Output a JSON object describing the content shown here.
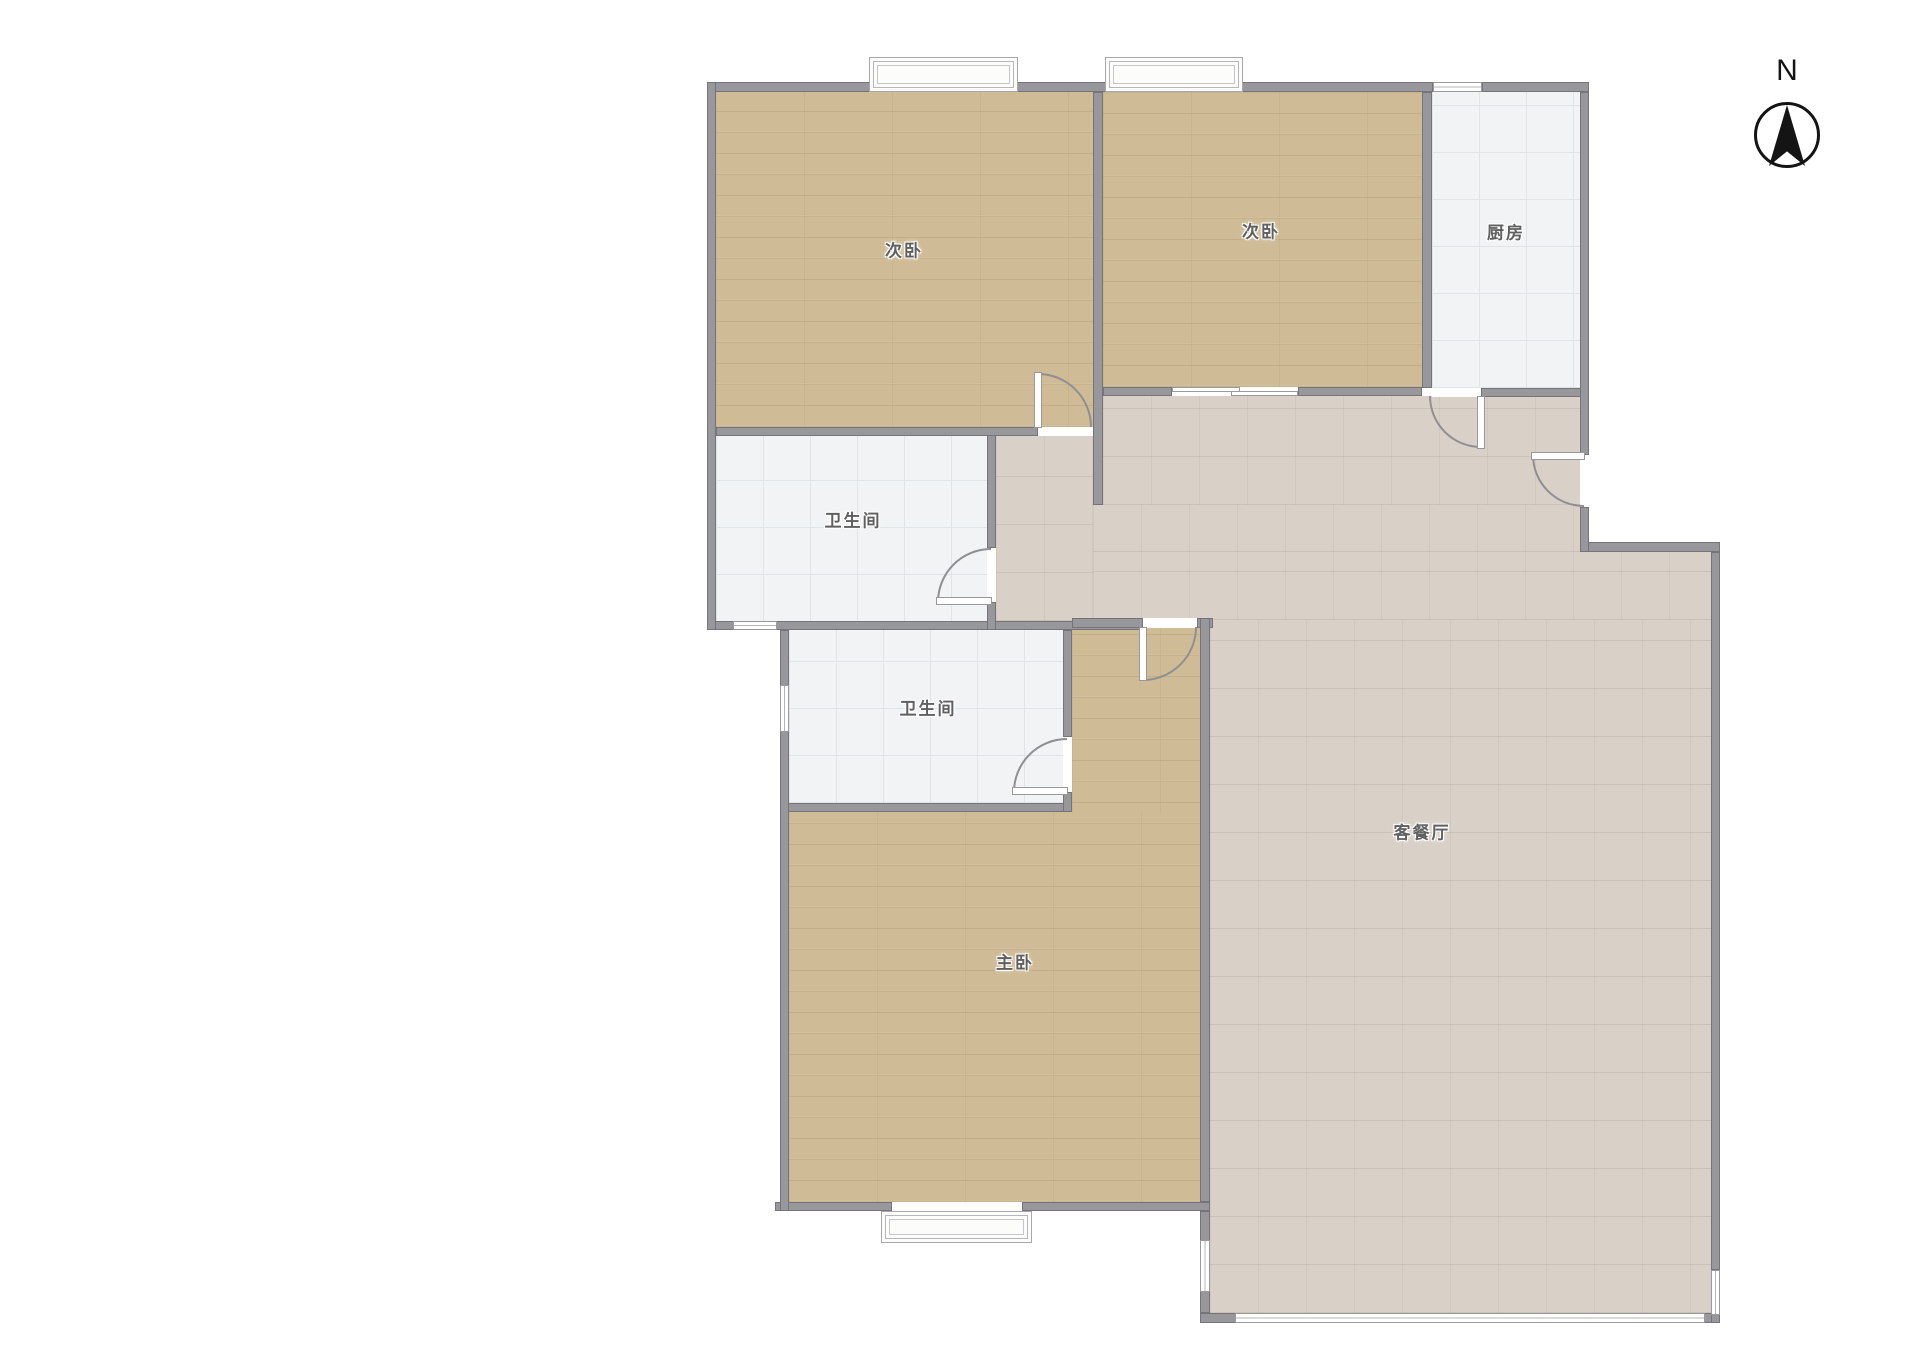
{
  "meta": {
    "type": "floor-plan",
    "language": "zh-CN"
  },
  "compass": {
    "label": "N"
  },
  "colors": {
    "wall": "#98989c",
    "wood_floor": "#cfbc96",
    "white_tile": "#f1f3f4",
    "living_tile": "#d9d1c8",
    "background": "#ffffff",
    "label_text": "#606060"
  },
  "rooms": [
    {
      "id": "bedroom-1",
      "label": "次卧",
      "x": 904,
      "y": 249
    },
    {
      "id": "bedroom-2",
      "label": "次卧",
      "x": 1261,
      "y": 230
    },
    {
      "id": "kitchen",
      "label": "厨房",
      "x": 1506,
      "y": 231
    },
    {
      "id": "bathroom-1",
      "label": "卫生间",
      "x": 853,
      "y": 519
    },
    {
      "id": "bathroom-2",
      "label": "卫生间",
      "x": 928,
      "y": 707
    },
    {
      "id": "master-bedroom",
      "label": "主卧",
      "x": 1015,
      "y": 961
    },
    {
      "id": "living-dining",
      "label": "客餐厅",
      "x": 1422,
      "y": 831
    }
  ],
  "plan": {
    "floors": [
      {
        "n": "floor-bedroom-1",
        "c": "floor-wood",
        "x": 716,
        "y": 92,
        "w": 377,
        "h": 335
      },
      {
        "n": "floor-bedroom-2",
        "c": "floor-wood",
        "x": 1103,
        "y": 92,
        "w": 319,
        "h": 295
      },
      {
        "n": "floor-kitchen",
        "c": "floor-tile",
        "x": 1432,
        "y": 92,
        "w": 148,
        "h": 296
      },
      {
        "n": "floor-bathroom-1",
        "c": "floor-tile",
        "x": 716,
        "y": 436,
        "w": 271,
        "h": 186
      },
      {
        "n": "floor-corridor",
        "c": "floor-living",
        "x": 996,
        "y": 436,
        "w": 97,
        "h": 185
      },
      {
        "n": "floor-bathroom-2",
        "c": "floor-tile",
        "x": 789,
        "y": 630,
        "w": 274,
        "h": 173
      },
      {
        "n": "floor-living-a",
        "c": "floor-living",
        "x": 1103,
        "y": 396,
        "w": 477,
        "h": 109
      },
      {
        "n": "floor-living-b",
        "c": "floor-living",
        "x": 1093,
        "y": 505,
        "w": 487,
        "h": 47
      },
      {
        "n": "floor-living-c",
        "c": "floor-living",
        "x": 1093,
        "y": 552,
        "w": 618,
        "h": 68
      },
      {
        "n": "floor-living-d",
        "c": "floor-living",
        "x": 1210,
        "y": 620,
        "w": 501,
        "h": 693
      },
      {
        "n": "floor-master-a",
        "c": "floor-wood",
        "x": 1072,
        "y": 628,
        "w": 128,
        "h": 574
      },
      {
        "n": "floor-master-b",
        "c": "floor-wood",
        "x": 789,
        "y": 812,
        "w": 411,
        "h": 390
      }
    ],
    "walls": [
      {
        "n": "wall-top-1",
        "x": 707,
        "y": 82,
        "w": 165,
        "h": 10
      },
      {
        "n": "wall-top-2",
        "x": 1015,
        "y": 82,
        "w": 93,
        "h": 10
      },
      {
        "n": "wall-top-3",
        "x": 1240,
        "y": 82,
        "w": 193,
        "h": 10
      },
      {
        "n": "wall-top-4",
        "x": 1482,
        "y": 82,
        "w": 107,
        "h": 10
      },
      {
        "n": "wall-bedroom1-bottom",
        "x": 716,
        "y": 427,
        "w": 322,
        "h": 9
      },
      {
        "n": "wall-bedroom2-bottom-l",
        "x": 1103,
        "y": 387,
        "w": 69,
        "h": 9
      },
      {
        "n": "wall-bedroom2-bottom-r",
        "x": 1298,
        "y": 387,
        "w": 124,
        "h": 9
      },
      {
        "n": "wall-kitchen-bottom",
        "x": 1481,
        "y": 388,
        "w": 108,
        "h": 9
      },
      {
        "n": "wall-bathrooms-band",
        "x": 707,
        "y": 621,
        "w": 436,
        "h": 9
      },
      {
        "n": "wall-master-top",
        "x": 1072,
        "y": 618,
        "w": 71,
        "h": 10
      },
      {
        "n": "wall-master-top-stub",
        "x": 1197,
        "y": 618,
        "w": 16,
        "h": 10
      },
      {
        "n": "wall-bathroom2-bottom",
        "x": 780,
        "y": 803,
        "w": 292,
        "h": 9
      },
      {
        "n": "wall-master-bottom-l",
        "x": 775,
        "y": 1202,
        "w": 117,
        "h": 9
      },
      {
        "n": "wall-master-bottom-r",
        "x": 1022,
        "y": 1202,
        "w": 188,
        "h": 9
      },
      {
        "n": "wall-step",
        "x": 1580,
        "y": 542,
        "w": 140,
        "h": 10
      },
      {
        "n": "wall-living-bottom",
        "x": 1200,
        "y": 1313,
        "w": 520,
        "h": 10
      },
      {
        "n": "wall-left-outer",
        "x": 707,
        "y": 82,
        "w": 9,
        "h": 548
      },
      {
        "n": "wall-left-lower",
        "x": 780,
        "y": 630,
        "w": 9,
        "h": 581
      },
      {
        "n": "wall-divider",
        "x": 1093,
        "y": 92,
        "w": 10,
        "h": 413
      },
      {
        "n": "wall-bathroom1-right-a",
        "x": 987,
        "y": 435,
        "w": 9,
        "h": 113
      },
      {
        "n": "wall-bathroom1-right-b",
        "x": 987,
        "y": 602,
        "w": 9,
        "h": 28
      },
      {
        "n": "wall-bed2-kitchen",
        "x": 1422,
        "y": 92,
        "w": 10,
        "h": 296
      },
      {
        "n": "wall-right-upper",
        "x": 1580,
        "y": 92,
        "w": 9,
        "h": 363
      },
      {
        "n": "wall-right-stub",
        "x": 1580,
        "y": 507,
        "w": 9,
        "h": 45
      },
      {
        "n": "wall-right-outer",
        "x": 1711,
        "y": 552,
        "w": 9,
        "h": 718
      },
      {
        "n": "wall-right-corner",
        "x": 1711,
        "y": 1313,
        "w": 9,
        "h": 10
      },
      {
        "n": "wall-master-right",
        "x": 1200,
        "y": 618,
        "w": 10,
        "h": 584
      },
      {
        "n": "wall-living-west",
        "x": 1200,
        "y": 1211,
        "w": 10,
        "h": 102
      },
      {
        "n": "wall-bathroom2-right-a",
        "x": 1063,
        "y": 630,
        "w": 9,
        "h": 107
      },
      {
        "n": "wall-bathroom2-right-b",
        "x": 1063,
        "y": 792,
        "w": 9,
        "h": 20
      }
    ],
    "thresholds": [
      {
        "n": "threshold-bedroom1-door",
        "x": 1038,
        "y": 427,
        "w": 54,
        "h": 9
      },
      {
        "n": "threshold-kitchen-door",
        "x": 1432,
        "y": 388,
        "w": 49,
        "h": 9
      },
      {
        "n": "threshold-master-door",
        "x": 1143,
        "y": 618,
        "w": 54,
        "h": 10
      },
      {
        "n": "threshold-bath1-door",
        "x": 987,
        "y": 548,
        "w": 9,
        "h": 54
      },
      {
        "n": "threshold-bath2-door",
        "x": 1063,
        "y": 737,
        "w": 9,
        "h": 55
      },
      {
        "n": "threshold-entry-door",
        "x": 1580,
        "y": 455,
        "w": 9,
        "h": 52
      },
      {
        "n": "threshold-sliding-door",
        "x": 1172,
        "y": 387,
        "w": 126,
        "h": 9
      }
    ],
    "windows": [
      {
        "n": "window-kitchen-top",
        "c": "win-h",
        "x": 1433,
        "y": 82,
        "w": 49,
        "h": 10
      },
      {
        "n": "window-bathroom1",
        "c": "win-h",
        "x": 733,
        "y": 621,
        "w": 44,
        "h": 9
      },
      {
        "n": "window-bathroom2",
        "c": "win-v",
        "x": 780,
        "y": 685,
        "w": 9,
        "h": 47
      },
      {
        "n": "window-living-west",
        "c": "win-v",
        "x": 1200,
        "y": 1240,
        "w": 10,
        "h": 52
      },
      {
        "n": "window-living-right",
        "c": "win-v",
        "x": 1711,
        "y": 1270,
        "w": 9,
        "h": 45
      },
      {
        "n": "window-living-bottom",
        "c": "win-h",
        "x": 1235,
        "y": 1313,
        "w": 470,
        "h": 10
      }
    ],
    "bay_windows": [
      {
        "n": "bay-window-bedroom1",
        "x": 869,
        "y": 57,
        "w": 149,
        "h": 35
      },
      {
        "n": "bay-window-bedroom2",
        "x": 1105,
        "y": 57,
        "w": 138,
        "h": 35
      },
      {
        "n": "bay-window-master",
        "x": 881,
        "y": 1211,
        "w": 151,
        "h": 32
      }
    ],
    "door_leaves": [
      {
        "n": "door-leaf-bedroom1",
        "x": 1034,
        "y": 372,
        "w": 8,
        "h": 56
      },
      {
        "n": "door-leaf-kitchen",
        "x": 1477,
        "y": 396,
        "w": 8,
        "h": 53
      },
      {
        "n": "door-leaf-master",
        "x": 1139,
        "y": 627,
        "w": 8,
        "h": 54
      },
      {
        "n": "door-leaf-bath1",
        "x": 936,
        "y": 597,
        "w": 56,
        "h": 8
      },
      {
        "n": "door-leaf-bath2",
        "x": 1012,
        "y": 787,
        "w": 56,
        "h": 8
      },
      {
        "n": "door-leaf-entry",
        "x": 1531,
        "y": 452,
        "w": 54,
        "h": 8
      }
    ],
    "sliding_panels": [
      {
        "n": "sliding-panel-1",
        "x": 1172,
        "y": 387,
        "w": 68,
        "h": 5
      },
      {
        "n": "sliding-panel-2",
        "x": 1231,
        "y": 391,
        "w": 67,
        "h": 5
      }
    ],
    "door_arcs": [
      {
        "n": "door-arc-bedroom1",
        "x": 1038,
        "y": 373,
        "w": 54,
        "h": 54,
        "corner": "tr"
      },
      {
        "n": "door-arc-kitchen",
        "x": 1429,
        "y": 396,
        "w": 52,
        "h": 52,
        "corner": "bl"
      },
      {
        "n": "door-arc-entry",
        "x": 1532,
        "y": 455,
        "w": 52,
        "h": 52,
        "corner": "bl"
      },
      {
        "n": "door-arc-bath1",
        "x": 937,
        "y": 548,
        "w": 54,
        "h": 54,
        "corner": "tl"
      },
      {
        "n": "door-arc-bath2",
        "x": 1013,
        "y": 738,
        "w": 54,
        "h": 54,
        "corner": "tl"
      },
      {
        "n": "door-arc-master",
        "x": 1143,
        "y": 627,
        "w": 54,
        "h": 54,
        "corner": "br"
      }
    ]
  }
}
